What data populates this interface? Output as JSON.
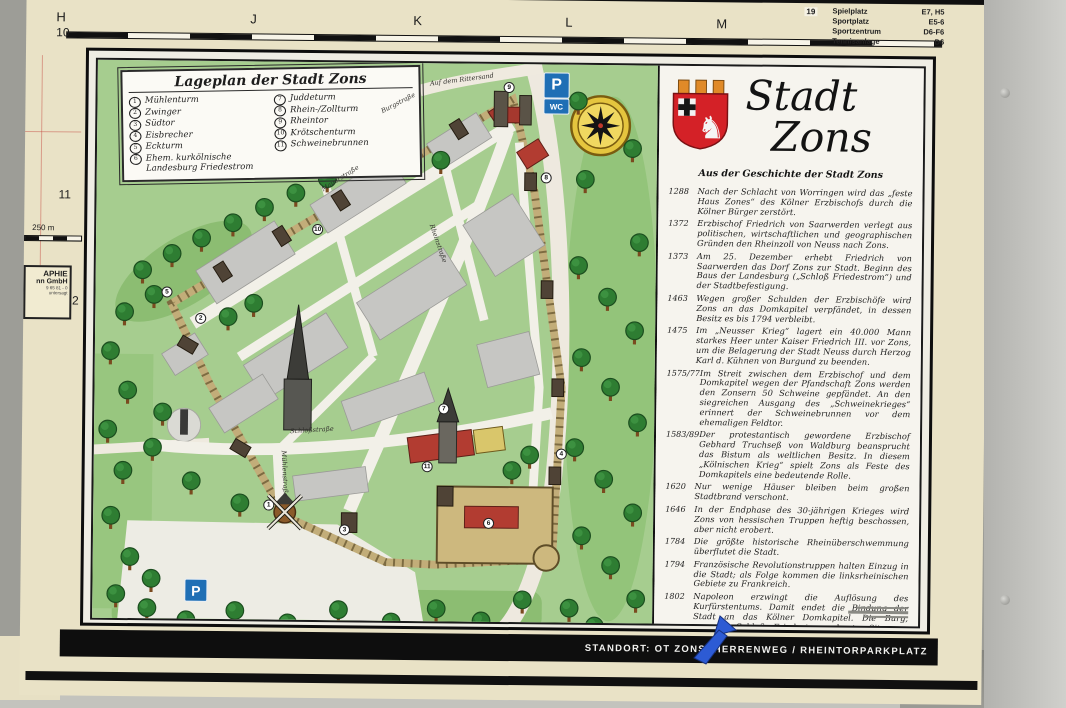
{
  "background_map": {
    "grid_letters": [
      "H",
      "J",
      "K",
      "L",
      "M"
    ],
    "grid_rows": [
      "10",
      "11",
      "12"
    ],
    "scale_label": "250 m",
    "publisher_box": [
      "APHIE",
      "nn GmbH",
      "9 65 81 - 0",
      "untersagt"
    ],
    "corner_ref": "19",
    "index_list": [
      {
        "label": "Spielplatz",
        "ref": "E7, H5"
      },
      {
        "label": "Sportplatz",
        "ref": "E5-6"
      },
      {
        "label": "Sportzentrum",
        "ref": "D6-F6"
      },
      {
        "label": "Tennisanlage",
        "ref": "D6"
      }
    ]
  },
  "legend": {
    "title": "Lageplan der Stadt Zons",
    "items_left": [
      {
        "n": "1",
        "label": "Mühlenturm"
      },
      {
        "n": "2",
        "label": "Zwinger"
      },
      {
        "n": "3",
        "label": "Südtor"
      },
      {
        "n": "4",
        "label": "Eisbrecher"
      },
      {
        "n": "5",
        "label": "Eckturm"
      },
      {
        "n": "6",
        "label": "Ehem. kurkölnische Landesburg Friedestrom"
      }
    ],
    "items_right": [
      {
        "n": "7",
        "label": "Juddeturm"
      },
      {
        "n": "8",
        "label": "Rhein-/Zollturm"
      },
      {
        "n": "9",
        "label": "Rheintor"
      },
      {
        "n": "10",
        "label": "Krötschenturm"
      },
      {
        "n": "11",
        "label": "Schweinebrunnen"
      }
    ]
  },
  "map": {
    "streets": [
      "Mauerstraße",
      "Rheinstraße",
      "Schloßstraße",
      "Mühlenstraße",
      "Burgstraße",
      "Auf dem Rittersand"
    ],
    "signs": {
      "parking": "P",
      "wc": "WC"
    }
  },
  "history": {
    "title_word1": "Stadt",
    "title_word2": "Zons",
    "subtitle": "Aus der Geschichte der Stadt Zons",
    "entries": [
      {
        "year": "1288",
        "text": "Nach der Schlacht von Worringen wird das „feste Haus Zones“ des Kölner Erzbischofs durch die Kölner Bürger zerstört."
      },
      {
        "year": "1372",
        "text": "Erzbischof Friedrich von Saarwerden verlegt aus politischen, wirtschaftlichen und geographischen Gründen den Rheinzoll von Neuss nach Zons."
      },
      {
        "year": "1373",
        "text": "Am 25. Dezember erhebt Friedrich von Saarwerden das Dorf Zons zur Stadt. Beginn des Baus der Landesburg („Schloß Friedestrom“) und der Stadtbefestigung."
      },
      {
        "year": "1463",
        "text": "Wegen großer Schulden der Erzbischöfe wird Zons an das Domkapitel verpfändet, in dessen Besitz es bis 1794 verbleibt."
      },
      {
        "year": "1475",
        "text": "Im „Neusser Krieg“ lagert ein 40.000 Mann starkes Heer unter Kaiser Friedrich III. vor Zons, um die Belagerung der Stadt Neuss durch Herzog Karl d. Kühnen von Burgund zu beenden."
      },
      {
        "year": "1575/77",
        "text": "Im Streit zwischen dem Erzbischof und dem Domkapitel wegen der Pfandschaft Zons werden den Zonsern 50 Schweine gepfändet. An den siegreichen Ausgang des „Schweinekrieges“ erinnert der Schweinebrunnen vor dem ehemaligen Feldtor."
      },
      {
        "year": "1583/89",
        "text": "Der protestantisch gewordene Erzbischof Gebhard Truchseß von Waldburg beansprucht das Bistum als weltlichen Besitz. In diesem „Kölnischen Krieg“ spielt Zons als Feste des Domkapitels eine bedeutende Rolle."
      },
      {
        "year": "1620",
        "text": "Nur wenige Häuser bleiben beim großen Stadtbrand verschont."
      },
      {
        "year": "1646",
        "text": "In der Endphase des 30-jährigen Krieges wird Zons von hessischen Truppen heftig beschossen, aber nicht erobert."
      },
      {
        "year": "1784",
        "text": "Die größte historische Rheinüberschwemmung überflutet die Stadt."
      },
      {
        "year": "1794",
        "text": "Französische Revolutionstruppen halten Einzug in die Stadt; als Folge kommen die linksrheinischen Gebiete zu Frankreich."
      },
      {
        "year": "1802",
        "text": "Napoleon erzwingt die Auflösung des Kurfürstentums. Damit endet die Bindung der Stadt an das Kölner Domkapitel. Die Burg, genannt Schloß Friedestrom, heute Sitz von Museen und Archiven, wird versteigert."
      },
      {
        "year": "1815",
        "text": "Der Wiener Kongreß schlägt die Rheinlande Preußen zu."
      },
      {
        "year": "1975",
        "text": "Die 600 Jahre alte Stadt Zons wird nach Dormagen eingemeindet."
      }
    ]
  },
  "footer": {
    "standort": "STANDORT:   OT ZONS, HERRENWEG / RHEINTORPARKPLATZ"
  },
  "colors": {
    "board_cream": "#e9e2c6",
    "map_green": "#a6cd8f",
    "wall_tan": "#c2ad79",
    "landmark_red": "#b23c31",
    "sign_blue": "#1f6fb5",
    "compass_yellow": "#e5c53e",
    "shield_red": "#d42127"
  }
}
